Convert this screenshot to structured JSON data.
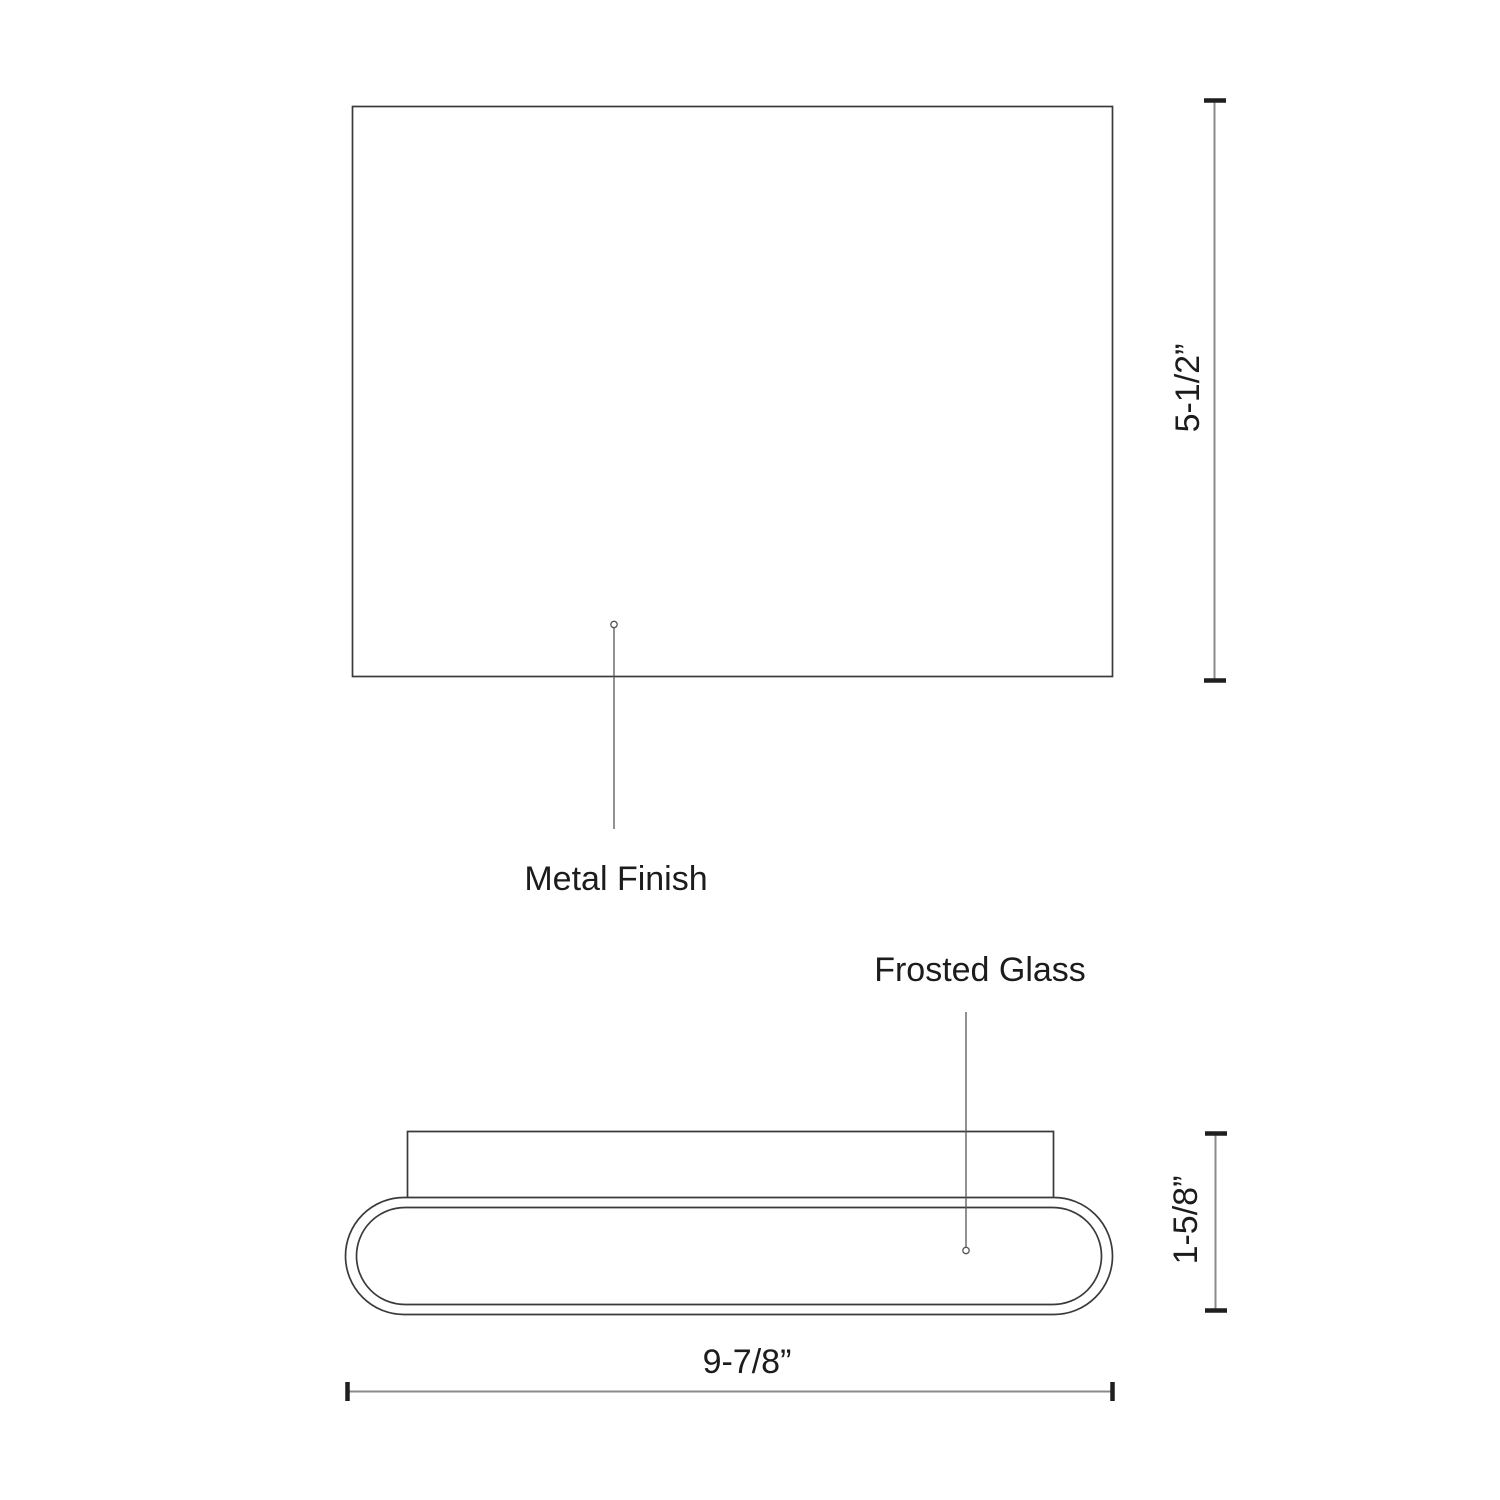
{
  "drawing": {
    "background": "#ffffff",
    "front_view": {
      "callout": {
        "label": "Metal Finish"
      }
    },
    "bottom_view": {
      "callout": {
        "label": "Frosted Glass"
      }
    },
    "dimensions": {
      "height": {
        "label": "5-1/2”"
      },
      "depth": {
        "label": "1-5/8”"
      },
      "width": {
        "label": "9-7/8”"
      }
    },
    "colors": {
      "outline": "#3a3a3a",
      "leader": "#565656",
      "dim_line": "#8a8a8a",
      "tick": "#1f1f1f",
      "text": "#1c1c1c"
    }
  }
}
